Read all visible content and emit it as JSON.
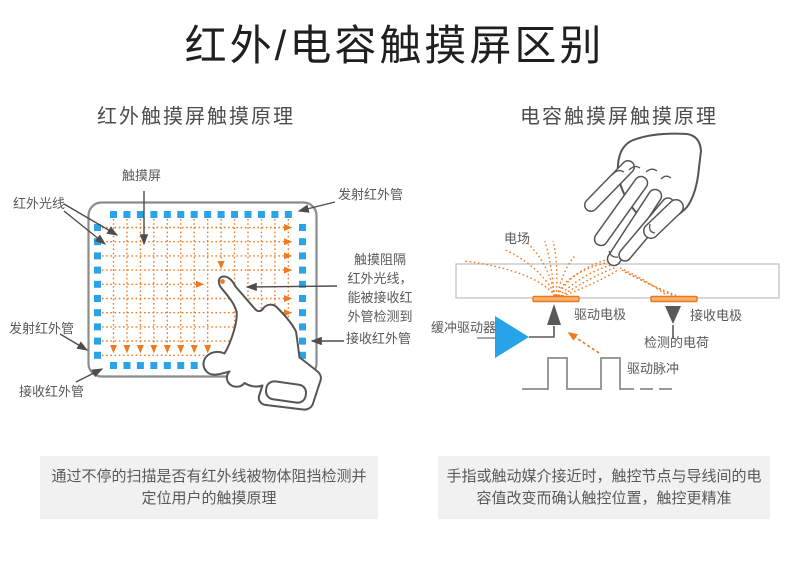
{
  "title": "红外/电容触摸屏区别",
  "left": {
    "heading": "红外触摸屏触摸原理",
    "labels": {
      "touchscreen": "触摸屏",
      "ir_rays": "红外光线",
      "emitter_top": "发射红外管",
      "emitter_left": "发射红外管",
      "receiver_right": "接收红外管",
      "receiver_bottom": "接收红外管",
      "block_note_lines": [
        "触摸阻隔",
        "红外光线，",
        "能被接收红",
        "外管检测到"
      ]
    },
    "caption": "通过不停的扫描是否有红外线被物体阻挡检测并定位用户的触摸原理"
  },
  "right": {
    "heading": "电容触摸屏触摸原理",
    "labels": {
      "efield": "电场",
      "buffer_driver": "缓冲驱动器",
      "drive_electrode": "驱动电极",
      "receive_electrode": "接收电极",
      "detected_charge": "检测的电荷",
      "drive_pulse": "驱动脉冲"
    },
    "caption": "手指或触动媒介接近时，触控节点与导线间的电容值改变而确认触控位置，触控更精准"
  },
  "colors": {
    "accent_blue": "#2BA3E9",
    "accent_orange": "#EE7B22",
    "gray_text": "#595959",
    "caption_bg": "#F1F1F2"
  }
}
